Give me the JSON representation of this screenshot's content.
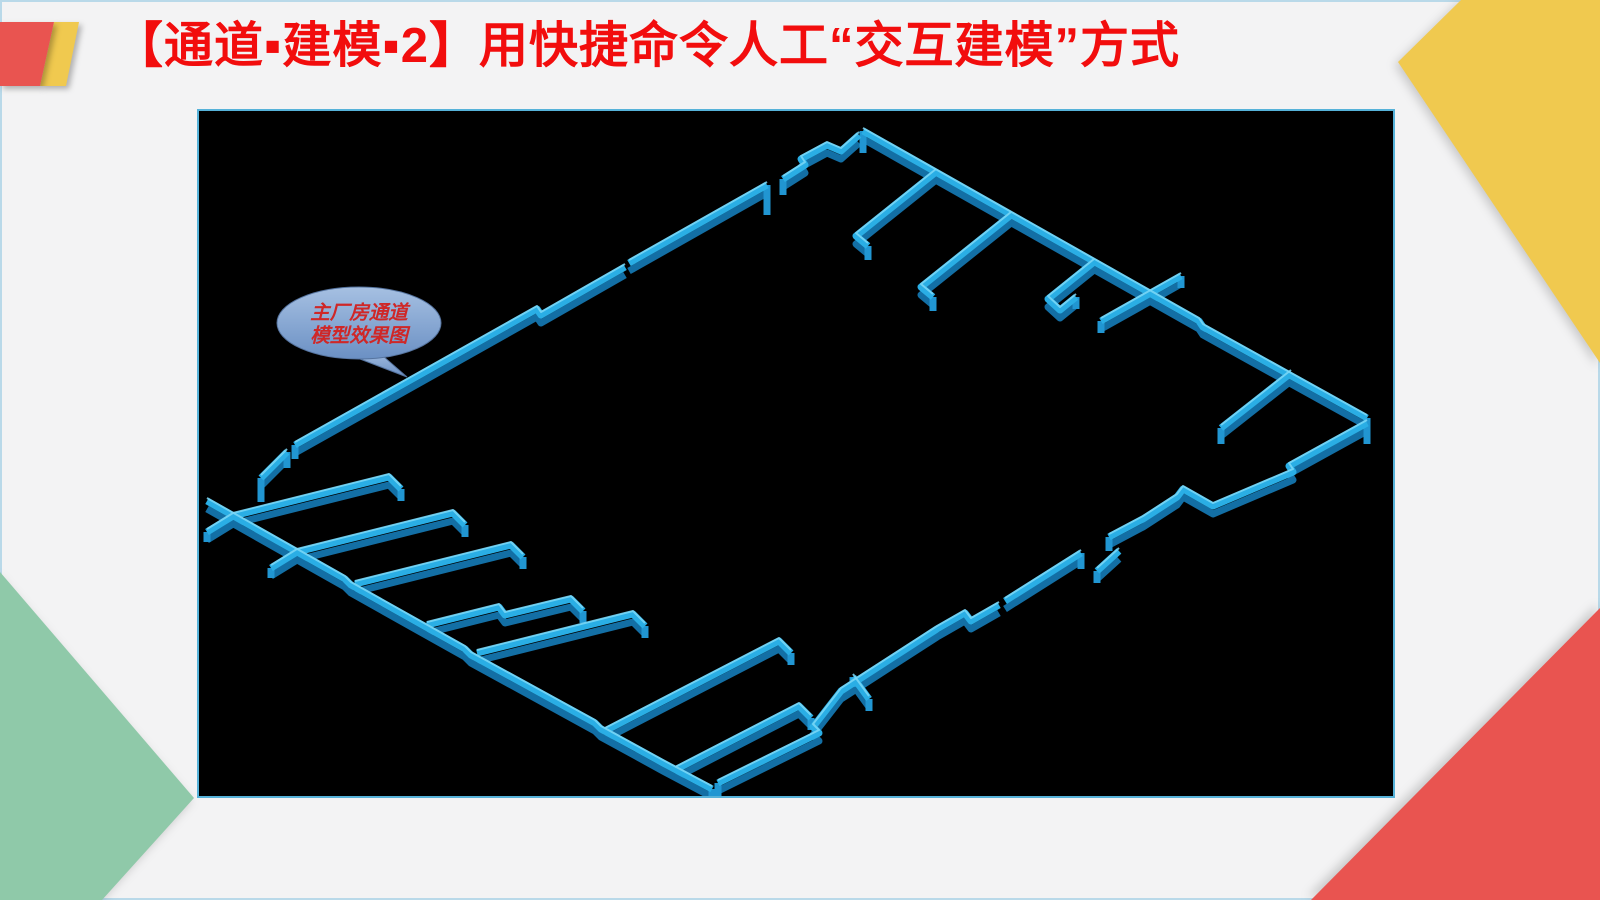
{
  "slide": {
    "title": "【通道▪建模▪2】用快捷命令人工“交互建模”方式",
    "colors": {
      "background": "#f3f3f4",
      "title": "#f20d0d",
      "slide_border": "#b9d9e9",
      "deco_red": "#e95450",
      "deco_yellow": "#f0c94f",
      "deco_green": "#8fc9a9"
    }
  },
  "viewport": {
    "background": "#000000",
    "border": "#56b2d9"
  },
  "callout": {
    "line1": "主厂房通道",
    "line2": "模型效果图",
    "text_color": "#cf2727",
    "fill_top": "#a6c0e2",
    "fill_bottom": "#6b90c4",
    "stroke": "#56749f"
  },
  "model": {
    "description": "isometric 3D wall model of main plant building channels",
    "colors": {
      "top": "#2aaee5",
      "side": "#136fa5",
      "highlight": "#7cd8f7",
      "cap": "#2196d2"
    },
    "walls": [
      {
        "name": "nw-edge-low",
        "pts": [
          [
            62,
            367
          ],
          [
            88,
            341
          ]
        ]
      },
      {
        "name": "nw-edge-main",
        "pts": [
          [
            96,
            334
          ],
          [
            338,
            198
          ],
          [
            342,
            204
          ],
          [
            426,
            156
          ]
        ]
      },
      {
        "name": "nw-edge-upper",
        "pts": [
          [
            430,
            152
          ],
          [
            568,
            74
          ]
        ]
      },
      {
        "name": "nw-zigzag",
        "pts": [
          [
            584,
            68
          ],
          [
            606,
            54
          ],
          [
            602,
            48
          ],
          [
            628,
            34
          ],
          [
            642,
            40
          ],
          [
            660,
            24
          ]
        ]
      },
      {
        "name": "ne-edge",
        "pts": [
          [
            664,
            20
          ],
          [
            1000,
            210
          ],
          [
            1004,
            216
          ],
          [
            1168,
            307
          ]
        ]
      },
      {
        "name": "ne-stub-1",
        "pts": [
          [
            737,
            61
          ],
          [
            657,
            125
          ],
          [
            669,
            135
          ]
        ]
      },
      {
        "name": "ne-stub-2",
        "pts": [
          [
            812,
            104
          ],
          [
            722,
            176
          ],
          [
            734,
            186
          ]
        ]
      },
      {
        "name": "ne-stub-3",
        "pts": [
          [
            895,
            151
          ],
          [
            849,
            188
          ],
          [
            861,
            199
          ],
          [
            877,
            186
          ]
        ]
      },
      {
        "name": "ne-corridor",
        "pts": [
          [
            902,
            210
          ],
          [
            982,
            165
          ]
        ]
      },
      {
        "name": "ne-stub-4",
        "pts": [
          [
            1092,
            262
          ],
          [
            1022,
            317
          ]
        ]
      },
      {
        "name": "se-edge-1",
        "pts": [
          [
            1168,
            312
          ],
          [
            1090,
            355
          ],
          [
            1094,
            361
          ],
          [
            1014,
            395
          ],
          [
            984,
            378
          ],
          [
            978,
            386
          ],
          [
            944,
            408
          ],
          [
            910,
            426
          ]
        ]
      },
      {
        "name": "se-edge-2",
        "pts": [
          [
            882,
            442
          ],
          [
            806,
            490
          ]
        ]
      },
      {
        "name": "se-stub",
        "pts": [
          [
            920,
            440
          ],
          [
            898,
            460
          ]
        ]
      },
      {
        "name": "se-edge-3",
        "pts": [
          [
            800,
            494
          ],
          [
            772,
            510
          ],
          [
            766,
            502
          ],
          [
            738,
            518
          ],
          [
            642,
            580
          ],
          [
            614,
            616
          ],
          [
            620,
            622
          ],
          [
            519,
            672
          ]
        ]
      },
      {
        "name": "se-tstub",
        "pts": [
          [
            654,
            566
          ],
          [
            670,
            588
          ]
        ]
      },
      {
        "name": "sw-edge",
        "pts": [
          [
            8,
            390
          ],
          [
            146,
            468
          ],
          [
            152,
            474
          ],
          [
            266,
            538
          ],
          [
            272,
            544
          ],
          [
            396,
            612
          ],
          [
            402,
            618
          ],
          [
            464,
            652
          ],
          [
            513,
            678
          ]
        ]
      },
      {
        "name": "sw-stub-1",
        "pts": [
          [
            34,
            405
          ],
          [
            190,
            366
          ],
          [
            202,
            378
          ]
        ]
      },
      {
        "name": "sw-stub-2",
        "pts": [
          [
            98,
            441
          ],
          [
            254,
            402
          ],
          [
            266,
            414
          ]
        ]
      },
      {
        "name": "sw-stub-3",
        "pts": [
          [
            156,
            473
          ],
          [
            312,
            434
          ],
          [
            324,
            446
          ]
        ]
      },
      {
        "name": "sw-stub-4",
        "pts": [
          [
            228,
            514
          ],
          [
            300,
            496
          ],
          [
            306,
            504
          ],
          [
            372,
            488
          ],
          [
            384,
            500
          ]
        ]
      },
      {
        "name": "sw-stub-5",
        "pts": [
          [
            278,
            542
          ],
          [
            434,
            503
          ],
          [
            446,
            515
          ]
        ]
      },
      {
        "name": "sw-ext-1",
        "pts": [
          [
            34,
            405
          ],
          [
            8,
            421
          ]
        ]
      },
      {
        "name": "sw-ext-2",
        "pts": [
          [
            98,
            441
          ],
          [
            72,
            457
          ]
        ]
      },
      {
        "name": "s-double-1",
        "pts": [
          [
            406,
            620
          ],
          [
            580,
            530
          ],
          [
            592,
            542
          ]
        ]
      },
      {
        "name": "s-double-2",
        "pts": [
          [
            476,
            659
          ],
          [
            600,
            595
          ],
          [
            612,
            607
          ]
        ]
      }
    ],
    "caps": [
      [
        62,
        367,
        24
      ],
      [
        88,
        341,
        16
      ],
      [
        96,
        334,
        14
      ],
      [
        568,
        74,
        30
      ],
      [
        584,
        68,
        16
      ],
      [
        664,
        20,
        22
      ],
      [
        1168,
        307,
        26
      ],
      [
        669,
        135,
        14
      ],
      [
        734,
        186,
        14
      ],
      [
        877,
        186,
        12
      ],
      [
        902,
        210,
        12
      ],
      [
        982,
        165,
        12
      ],
      [
        1022,
        317,
        16
      ],
      [
        910,
        426,
        14
      ],
      [
        882,
        442,
        16
      ],
      [
        898,
        460,
        12
      ],
      [
        670,
        588,
        12
      ],
      [
        519,
        672,
        18
      ],
      [
        513,
        678,
        16
      ],
      [
        202,
        378,
        12
      ],
      [
        266,
        414,
        12
      ],
      [
        324,
        446,
        12
      ],
      [
        384,
        500,
        12
      ],
      [
        446,
        515,
        12
      ],
      [
        8,
        421,
        10
      ],
      [
        72,
        457,
        10
      ],
      [
        592,
        542,
        12
      ],
      [
        612,
        607,
        12
      ],
      [
        654,
        566,
        10
      ]
    ]
  }
}
